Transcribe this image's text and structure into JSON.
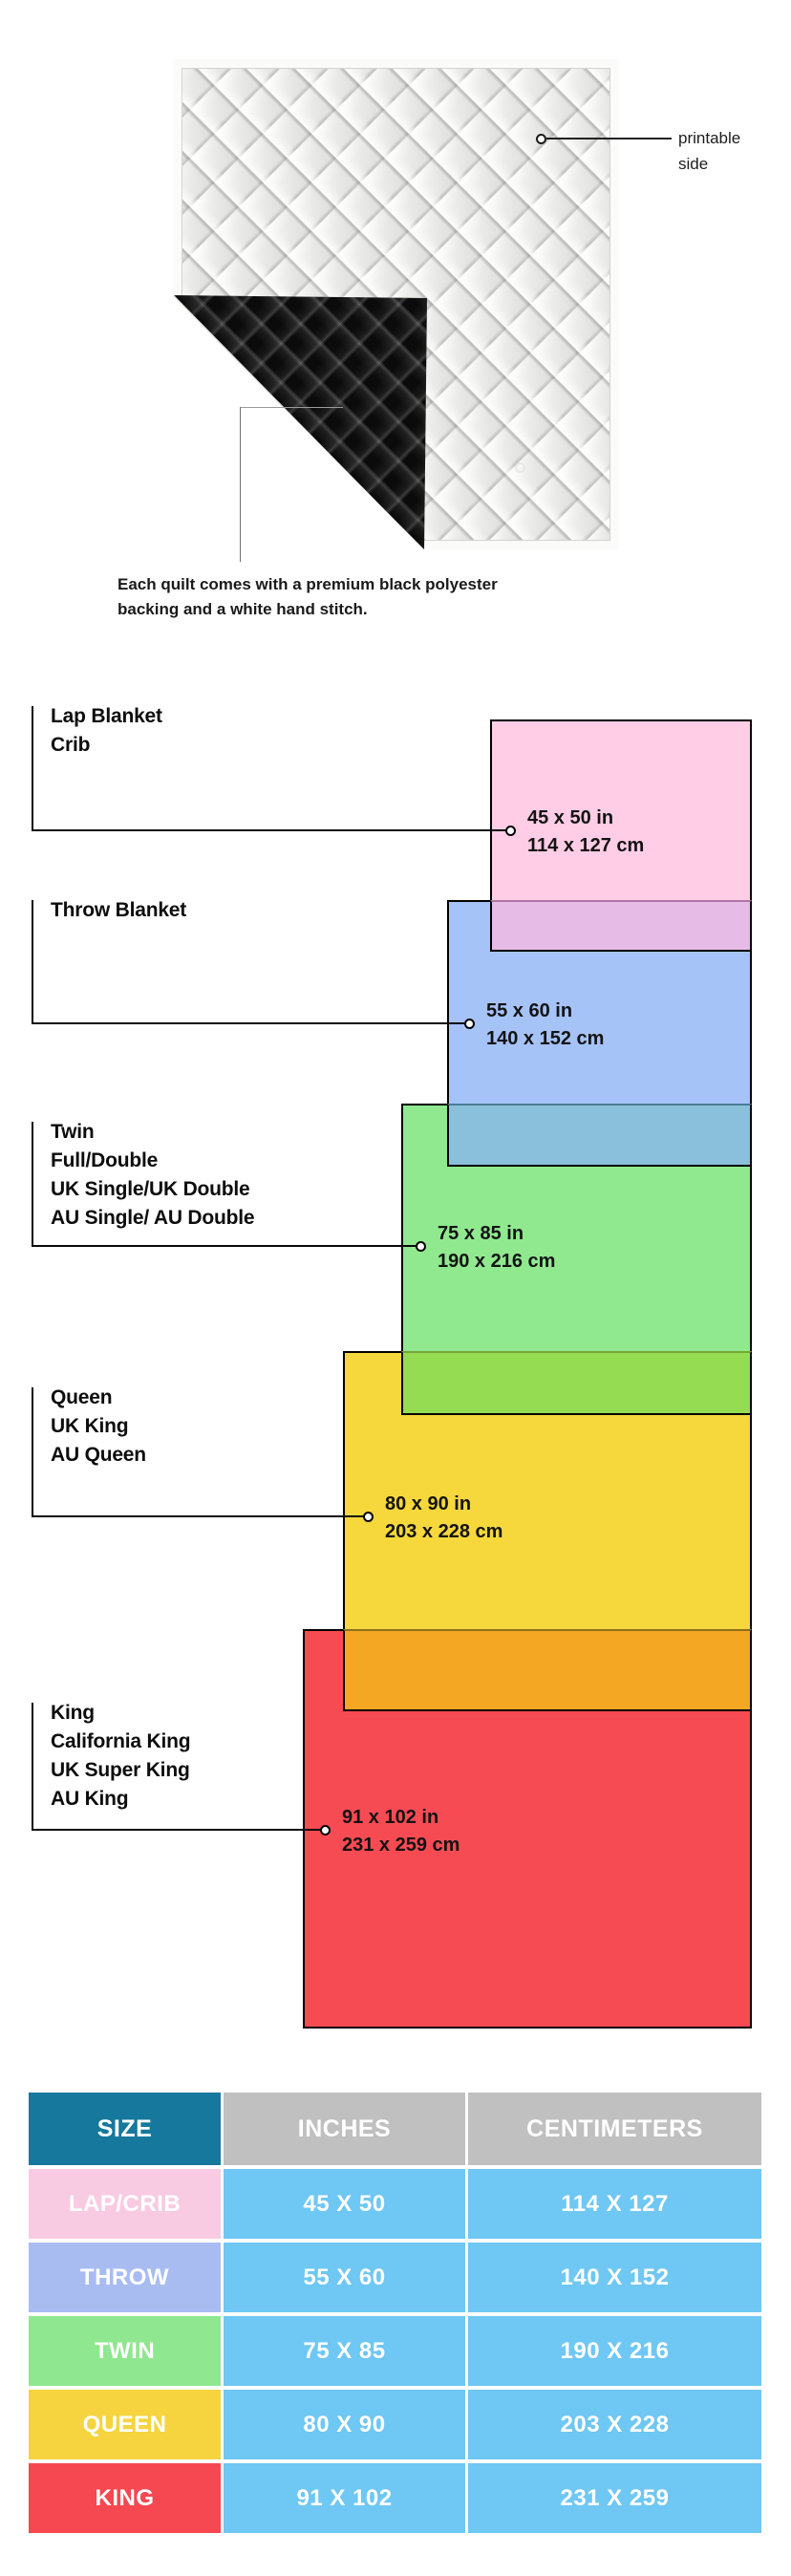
{
  "hero": {
    "printable_line1": "printable",
    "printable_line2": "side",
    "caption_line1": "Each quilt comes with a premium black polyester",
    "caption_line2": "backing and a white hand stitch."
  },
  "diagram": {
    "sizes": [
      {
        "id": "lap",
        "names": [
          "Lap Blanket",
          "Crib"
        ],
        "inches": "45 x 50 in",
        "cm": "114 x 127 cm",
        "fill": "#FFCDE6",
        "overlap_fill": "#E6BCE6",
        "overlap_line": "#AE76A4"
      },
      {
        "id": "throw",
        "names": [
          "Throw Blanket"
        ],
        "inches": "55 x 60 in",
        "cm": "140 x 152 cm",
        "fill": "#A6C3F8",
        "overlap_fill": "#8BC0DC",
        "overlap_line": "#4A7B95"
      },
      {
        "id": "twin",
        "names": [
          "Twin",
          "Full/Double",
          "UK Single/UK Double",
          "AU Single/ AU Double"
        ],
        "inches": "75 x 85 in",
        "cm": "190 x 216 cm",
        "fill": "#90E98F",
        "overlap_fill": "#95DC52",
        "overlap_line": "#79A637"
      },
      {
        "id": "queen",
        "names": [
          "Queen",
          "UK King",
          "AU Queen"
        ],
        "inches": "80 x 90 in",
        "cm": "203 x 228 cm",
        "fill": "#F6D83C",
        "overlap_fill": "#F3A722",
        "overlap_line": "#8F701C"
      },
      {
        "id": "king",
        "names": [
          "King",
          "California King",
          "UK Super King",
          "AU King"
        ],
        "inches": "91 x 102 in",
        "cm": "231 x 259 cm",
        "fill": "#F74B53",
        "overlap_fill": null,
        "overlap_line": null
      }
    ],
    "line_color": "#0A0A0A"
  },
  "table": {
    "headers": [
      {
        "label": "SIZE",
        "bg": "#16789D"
      },
      {
        "label": "INCHES",
        "bg": "#C0C0C0"
      },
      {
        "label": "CENTIMETERS",
        "bg": "#C0C0C0"
      }
    ],
    "value_cell_bg": "#6FC7F3",
    "text_color": "#FFFFFF",
    "rows": [
      {
        "size": "LAP/CRIB",
        "inches": "45 X 50",
        "cm": "114 X 127",
        "bg": "#F9CBE3"
      },
      {
        "size": "THROW",
        "inches": "55 X 60",
        "cm": "140 X 152",
        "bg": "#A9BCF2"
      },
      {
        "size": "TWIN",
        "inches": "75 X 85",
        "cm": "190 X 216",
        "bg": "#8FE78F"
      },
      {
        "size": "QUEEN",
        "inches": "80 X 90",
        "cm": "203 X 228",
        "bg": "#F5D43F"
      },
      {
        "size": "KING",
        "inches": "91 X 102",
        "cm": "231 X 259",
        "bg": "#F54850"
      }
    ]
  }
}
